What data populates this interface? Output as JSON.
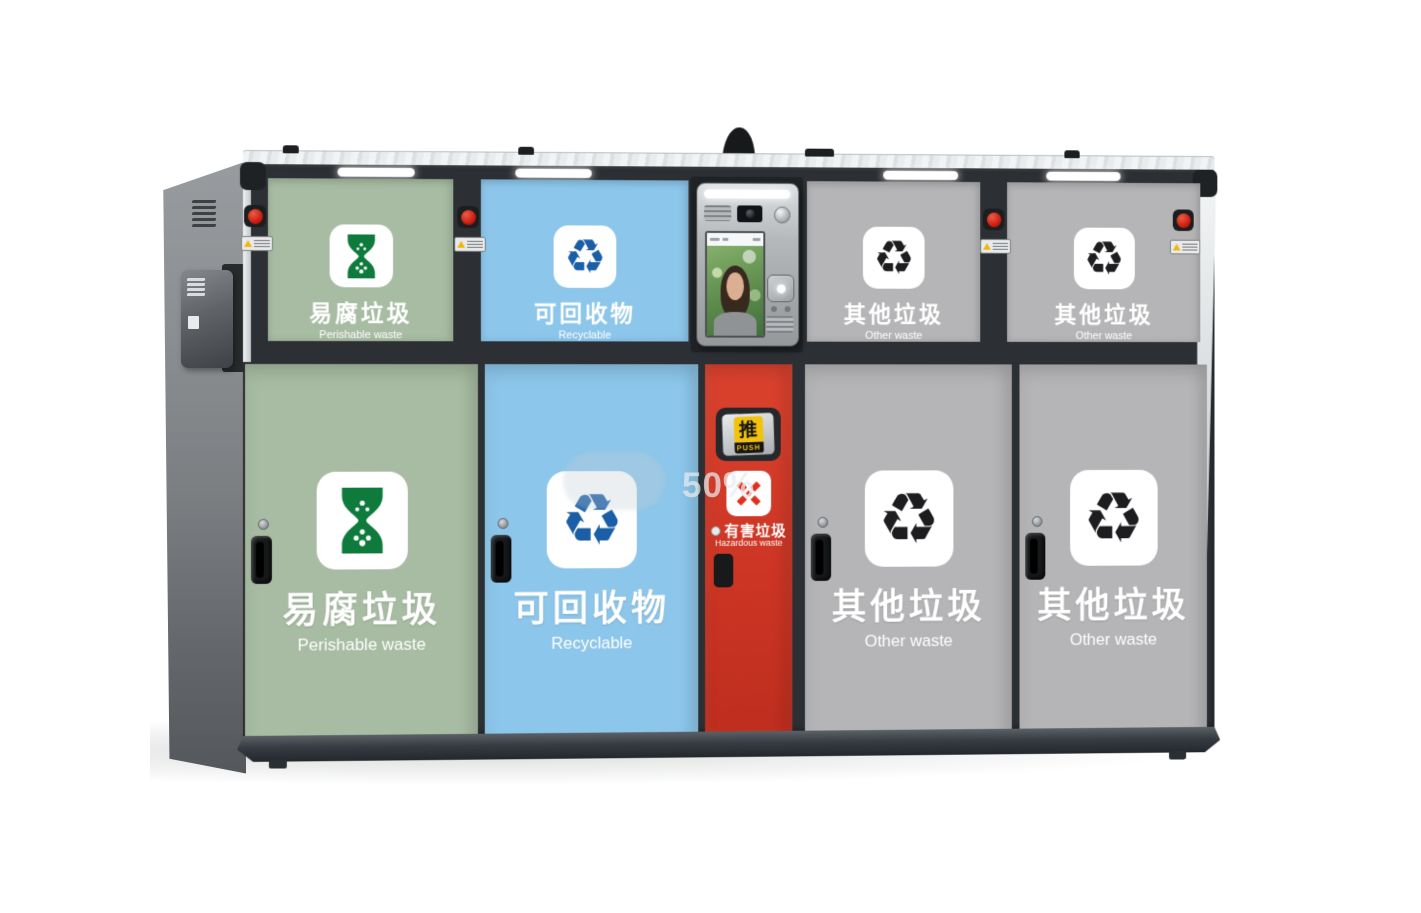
{
  "watermark": "50%",
  "push_flap": {
    "zh": "推",
    "en": "PUSH"
  },
  "icons": {
    "recycle_glyph": "♻",
    "other_waste_glyph": "♻"
  },
  "colors": {
    "perishable_panel": "#a7bca2",
    "recyclable_panel": "#8cc6ea",
    "other_panel": "#b5b5b7",
    "hazardous_door": "#cb3423",
    "hourglass_green": "#0e7b3c",
    "recycle_blue": "#1a5ea8",
    "other_black": "#1d1d1f",
    "hazard_red": "#e2301f",
    "frame_dark": "#2c2f33",
    "push_yellow": "#f2c30c"
  },
  "top_panels": [
    {
      "zh": "易腐垃圾",
      "en": "Perishable waste",
      "icon": "hourglass-icon"
    },
    {
      "zh": "可回收物",
      "en": "Recyclable",
      "icon": "recycle-icon"
    },
    {
      "zh": "其他垃圾",
      "en": "Other waste",
      "icon": "other-waste-icon"
    },
    {
      "zh": "其他垃圾",
      "en": "Other waste",
      "icon": "other-waste-icon"
    }
  ],
  "doors": [
    {
      "zh": "易腐垃圾",
      "en": "Perishable waste",
      "icon": "hourglass-icon"
    },
    {
      "zh": "可回收物",
      "en": "Recyclable",
      "icon": "recycle-icon"
    },
    {
      "zh": "有害垃圾",
      "en": "Hazardous waste",
      "icon": "hazardous-icon"
    },
    {
      "zh": "其他垃圾",
      "en": "Other waste",
      "icon": "other-waste-icon"
    },
    {
      "zh": "其他垃圾",
      "en": "Other waste",
      "icon": "other-waste-icon"
    }
  ]
}
